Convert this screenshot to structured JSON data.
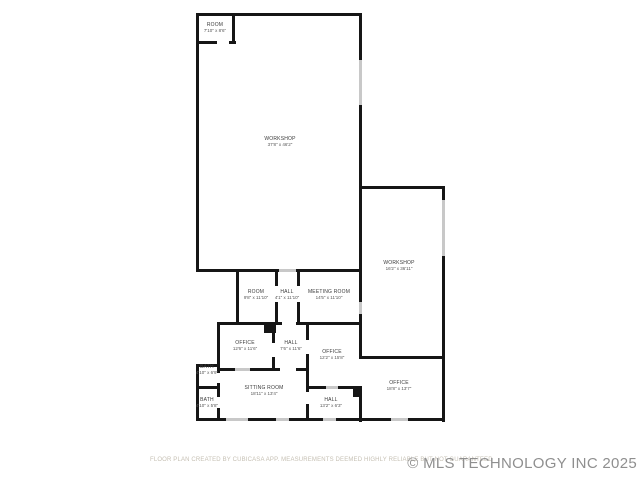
{
  "page": {
    "background_color": "#ffffff",
    "wall_color": "#161616",
    "window_color": "#c8c8c8",
    "label_color": "#3a3a3a"
  },
  "floor_plan": {
    "rooms": [
      {
        "name": "ROOM",
        "dims": "7'10\" x 8'6\""
      },
      {
        "name": "WORKSHOP",
        "dims": "37'8\" x 46'2\""
      },
      {
        "name": "WORKSHOP",
        "dims": "16'2\" x 36'11\""
      },
      {
        "name": "ROOM",
        "dims": "9'8\" x 11'10\""
      },
      {
        "name": "HALL",
        "dims": "4'1\" x 11'10\""
      },
      {
        "name": "MEETING ROOM",
        "dims": "14'5\" x 11'10\""
      },
      {
        "name": "OFFICE",
        "dims": "12'6\" x 11'6\""
      },
      {
        "name": "HALL",
        "dims": "7'6\" x 11'6\""
      },
      {
        "name": "OFFICE",
        "dims": "12'2\" x 15'8\""
      },
      {
        "name": "BATH",
        "dims": "4'10\" x 6'9\""
      },
      {
        "name": "BATH",
        "dims": "4'10\" x 5'8\""
      },
      {
        "name": "SITTING ROOM",
        "dims": "18'11\" x 13'4\""
      },
      {
        "name": "HALL",
        "dims": "13'2\" x 6'3\""
      },
      {
        "name": "OFFICE",
        "dims": "18'8\" x 13'7\""
      }
    ]
  },
  "footer": {
    "disclaimer": "FLOOR PLAN CREATED BY CUBICASA APP. MEASUREMENTS DEEMED HIGHLY RELIABLE BUT NOT GUARANTEED",
    "watermark": "© MLS TECHNOLOGY INC 2025",
    "disclaimer_color": "#c6c0b4",
    "watermark_color": "#8f8f8f"
  }
}
